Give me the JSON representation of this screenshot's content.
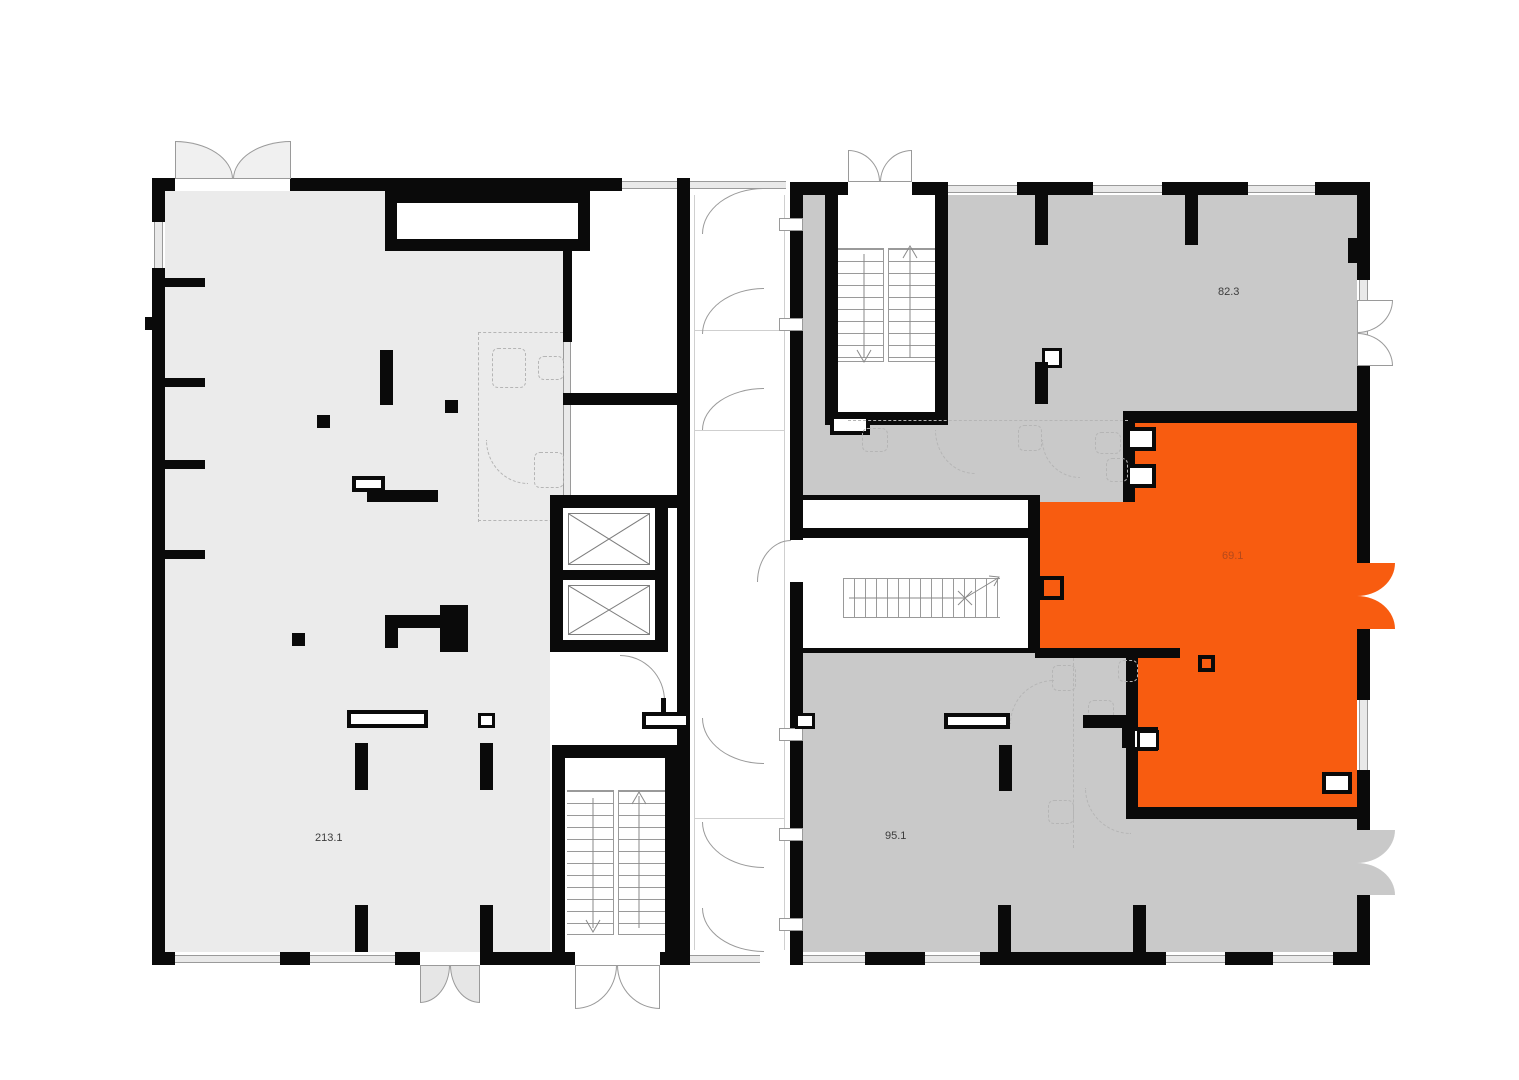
{
  "title": "Floor plan",
  "units": [
    {
      "id": "unit-213-1",
      "label": "213.1",
      "selected": false
    },
    {
      "id": "unit-82-3",
      "label": "82.3",
      "selected": false
    },
    {
      "id": "unit-69-1",
      "label": "69.1",
      "selected": true
    },
    {
      "id": "unit-95-1",
      "label": "95.1",
      "selected": false
    }
  ],
  "colors": {
    "wall": "#0a0a0a",
    "lfill": "#ebebeb",
    "rfill": "#c9c9c9",
    "orange": "#f85c10",
    "line": "#9a9a9a",
    "dash": "#b5b5b5",
    "label": "#3c3c3c",
    "labelOrange": "#b5491b"
  },
  "symbols": {
    "elevator": "crossed-box",
    "stairs": "treads-with-direction-arrow",
    "door": "quarter-circle-swing",
    "double_door": "paired-fan-leaves",
    "window": "thin-double-line",
    "plumbing_fixture": "dashed-outline"
  }
}
